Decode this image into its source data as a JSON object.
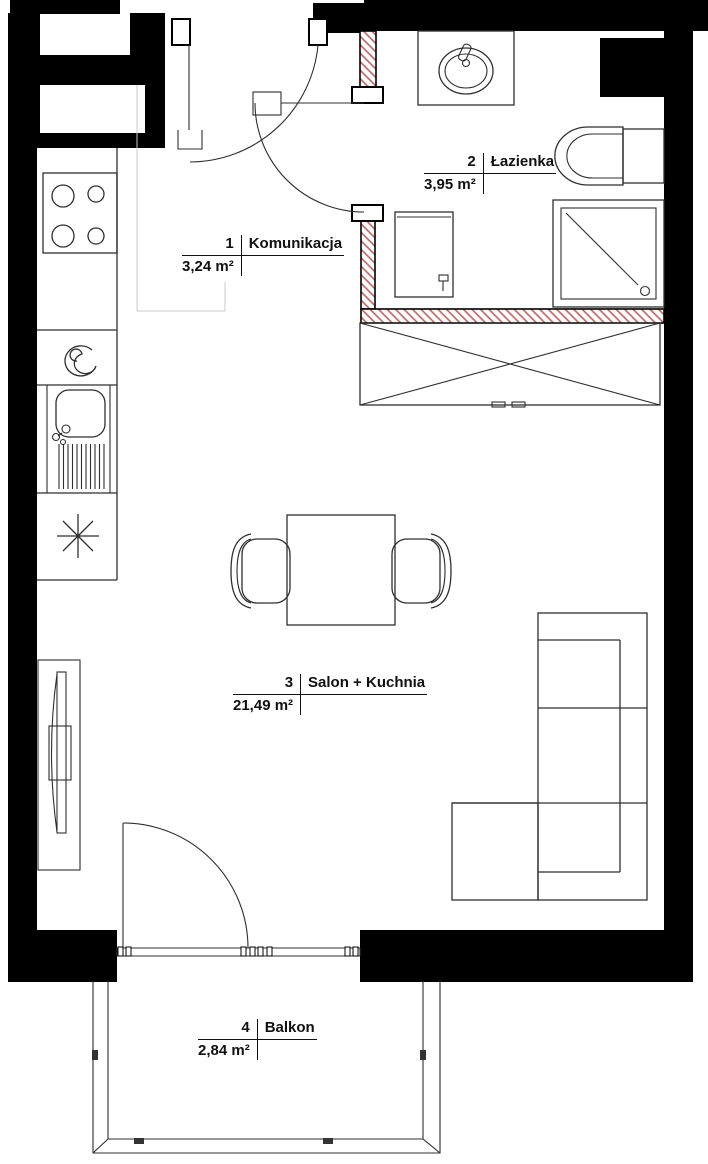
{
  "rooms": [
    {
      "number": "1",
      "name": "Komunikacja",
      "area": "3,24 m²"
    },
    {
      "number": "2",
      "name": "Łazienka",
      "area": "3,95 m²"
    },
    {
      "number": "3",
      "name": "Salon + Kuchnia",
      "area": "21,49 m²"
    },
    {
      "number": "4",
      "name": "Balkon",
      "area": "2,84 m²"
    }
  ],
  "colors": {
    "wall": "#000000",
    "new_wall_hatch": "#c0605f",
    "furniture_line": "#2f2f2f",
    "zone_line": "#c9c9c9",
    "background": "#ffffff"
  }
}
